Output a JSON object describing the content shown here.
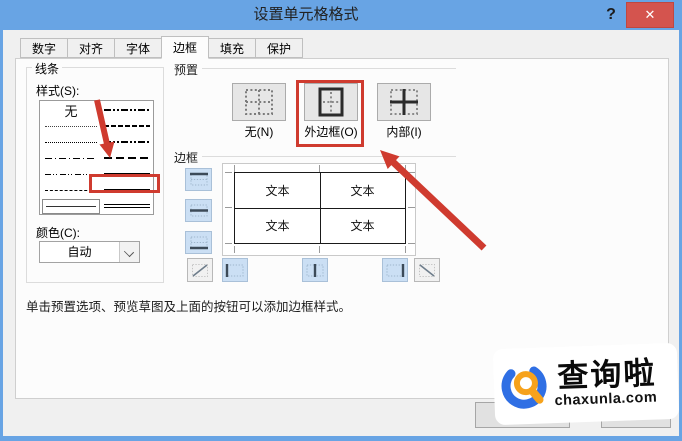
{
  "window": {
    "title": "设置单元格格式",
    "help_icon": "?",
    "close_icon": "✕"
  },
  "tabs": [
    {
      "label": "数字",
      "active": false
    },
    {
      "label": "对齐",
      "active": false
    },
    {
      "label": "字体",
      "active": false
    },
    {
      "label": "边框",
      "active": true
    },
    {
      "label": "填充",
      "active": false
    },
    {
      "label": "保护",
      "active": false
    }
  ],
  "line_panel": {
    "title": "线条",
    "style_label": "样式(S):",
    "none_option": "无",
    "left_styles": [
      "none",
      "fine-dotted",
      "dotted",
      "dash-dot",
      "dash-dot-dot",
      "dashed",
      "thin-solid-selected"
    ],
    "right_styles": [
      "medium-dash-dot-dot",
      "medium-dash-dot-dense",
      "medium-dash-dot-dot-bold",
      "medium-dashed",
      "medium-solid",
      "thick-solid-highlighted",
      "double-line"
    ],
    "color_label": "颜色(C):",
    "color_value": "自动"
  },
  "presets_panel": {
    "title": "预置",
    "items": [
      {
        "label": "无(N)",
        "icon": "preset-none-icon",
        "highlighted": false
      },
      {
        "label": "外边框(O)",
        "icon": "preset-outline-icon",
        "highlighted": true
      },
      {
        "label": "内部(I)",
        "icon": "preset-inside-icon",
        "highlighted": false
      }
    ]
  },
  "border_panel": {
    "title": "边框",
    "cell_text": "文本",
    "edge_buttons": [
      "top-border",
      "middle-horizontal-border",
      "bottom-border",
      "diagonal-up",
      "left-border",
      "middle-vertical-border",
      "right-border",
      "diagonal-down"
    ]
  },
  "hint_text": "单击预置选项、预览草图及上面的按钮可以添加边框样式。",
  "watermark": {
    "brand": "查询啦",
    "domain": "chaxunla.com",
    "blue": "#2f6fe4",
    "orange": "#f6a21c"
  },
  "annotation_color": "#cf3b2f"
}
